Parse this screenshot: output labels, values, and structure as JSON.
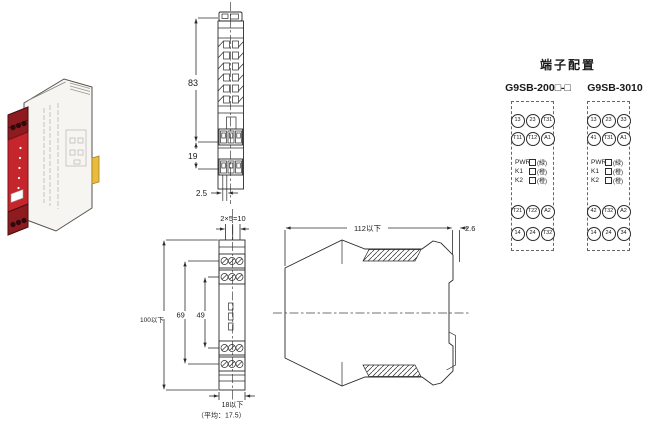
{
  "terminal_config": {
    "heading": "端子配置",
    "models": [
      {
        "name": "G9SB-200□-□",
        "row1": [
          "13",
          "23",
          "T31"
        ],
        "row2": [
          "T11",
          "T12",
          "A1"
        ],
        "indicators": [
          {
            "label": "PWR",
            "color": "(緑)"
          },
          {
            "label": "K1",
            "color": "(橙)"
          },
          {
            "label": "K2",
            "color": "(橙)"
          }
        ],
        "row3": [
          "T21",
          "T22",
          "A2"
        ],
        "row4": [
          "14",
          "24",
          "T32"
        ]
      },
      {
        "name": "G9SB-3010",
        "row1": [
          "13",
          "23",
          "33"
        ],
        "row2": [
          "41",
          "T31",
          "A1"
        ],
        "indicators": [
          {
            "label": "PWR",
            "color": "(緑)"
          },
          {
            "label": "K1",
            "color": "(橙)"
          },
          {
            "label": "K2",
            "color": "(橙)"
          }
        ],
        "row3": [
          "42",
          "T32",
          "A2"
        ],
        "row4": [
          "14",
          "24",
          "34"
        ]
      }
    ]
  },
  "dimensions": {
    "front_view": {
      "height_upper": "83",
      "height_lower": "19",
      "pitch": "2.5"
    },
    "plan_view": {
      "holes": "2×5=10",
      "total_height": "100以下",
      "span_outer": "69",
      "span_inner": "49",
      "width": "18以下",
      "width_note": "（平均：17.5）"
    },
    "profile_view": {
      "depth": "112以下",
      "rail_gap": "2.6"
    }
  },
  "product_photo": {
    "colors": {
      "front_red": "#c5262c",
      "terminal_dark_red": "#8e1b1f",
      "housing": "#f6f5f1",
      "din_clip_yellow": "#e9bc3e"
    }
  }
}
